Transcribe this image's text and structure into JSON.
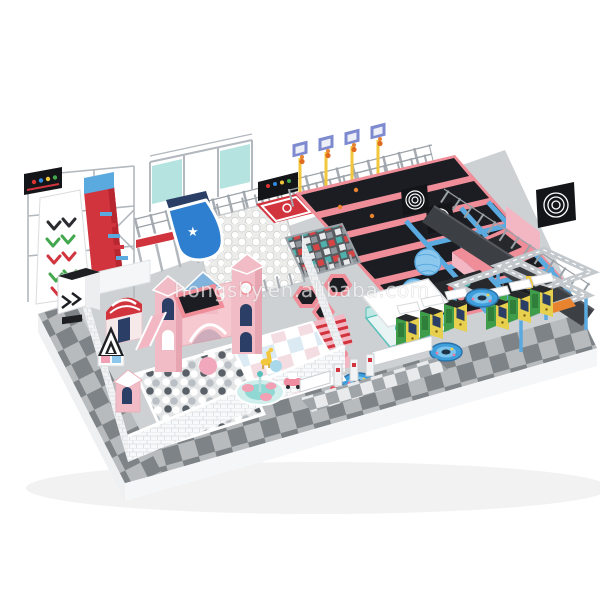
{
  "scene": {
    "type": "3d-render-indoor-playground-trampoline-park",
    "view": "isometric-product-render-on-white",
    "watermark": {
      "text": "hongshy.en.alibaba.com"
    },
    "areas": [
      {
        "name": "giant-chevron-slide",
        "color": "#f6f7f8"
      },
      {
        "name": "red-drop-slide",
        "color": "#d2343e"
      },
      {
        "name": "graffiti-signs",
        "color": "#141519"
      },
      {
        "name": "steel-mezzanine-frame",
        "color": "#b2b8be"
      },
      {
        "name": "blue-star-slide",
        "color": "#2f7fd0"
      },
      {
        "name": "white-ball-pit",
        "color": "#ececea"
      },
      {
        "name": "foam-cube-pit",
        "colors": [
          "#4fb0ac",
          "#d64545",
          "#e8eaeb"
        ]
      },
      {
        "name": "red-court-pad",
        "color": "#d2343e"
      },
      {
        "name": "dunk-basketball-hoops",
        "count": 4
      },
      {
        "name": "trampoline-grid-pink",
        "color": "#ef8e98"
      },
      {
        "name": "trampoline-grid-blue",
        "color": "#5aaae0"
      },
      {
        "name": "blue-wrecking-balls",
        "count": 2
      },
      {
        "name": "spiral-dart-targets",
        "count": 3
      },
      {
        "name": "stunt-jump-wedge",
        "color": "#ef8e98"
      },
      {
        "name": "ninja-truss-course",
        "color": "#c3c8cd"
      },
      {
        "name": "dark-walkway",
        "color": "#3c4045"
      },
      {
        "name": "claw-machines",
        "count": 6,
        "colors": [
          "#3f9c4b",
          "#e6d04e"
        ]
      },
      {
        "name": "blue-spinning-rides",
        "count": 3,
        "color": "#3f9fdc"
      },
      {
        "name": "teal-party-kiosk",
        "color": "#58c0ba"
      },
      {
        "name": "hexagon-trampolines",
        "count": 3
      },
      {
        "name": "toddler-castle-town",
        "color": "#f2bcc6"
      },
      {
        "name": "toddler-ball-pit",
        "colors": [
          "#ffffff",
          "#b9bfc4",
          "#596067"
        ]
      },
      {
        "name": "pastel-checker-floor",
        "colors": [
          "#f3dde3",
          "#dceaf4"
        ]
      },
      {
        "name": "soft-seat-carousel",
        "color": "#f2a0b4"
      },
      {
        "name": "ride-on-cars",
        "count": 2
      },
      {
        "name": "entrance-turnstiles",
        "count": 3
      },
      {
        "name": "checkerboard-apron",
        "colors": [
          "#7e8387",
          "#b7bbbe"
        ]
      }
    ]
  },
  "icons": {
    "star": "★"
  },
  "palette": {
    "white": "#ffffff",
    "floor": "#cdd1d4",
    "slabSide": "#eef0f1",
    "slabSideLight": "#f5f6f7",
    "checkerDark": "#7e8387",
    "checkerMid": "#b7bbbe",
    "gateCheckA": "#9fa4a8",
    "gateCheckB": "#e8eaeb",
    "steel": "#b2b8be",
    "steelDark": "#9aa1a7",
    "fence": "#a5abb1",
    "pink": "#ef8e98",
    "pinkLight": "#f3b7c4",
    "pinkPale": "#f6c9d1",
    "castlePink": "#f2bcc6",
    "castleSide": "#e6a5b1",
    "red": "#d2343e",
    "crimson": "#b8262f",
    "navy": "#2b3f66",
    "blue": "#5aaae0",
    "blueDeep": "#2f7fd0",
    "bluePale": "#8cc8ee",
    "tramp": "#1b1d22",
    "dark": "#26282c",
    "signBlack": "#141519",
    "teal": "#58c0ba",
    "tealPale": "#bfe8e5",
    "green": "#43a84d",
    "yellow": "#f2c73c",
    "orange": "#e8832f",
    "arcadeYellow": "#e6d04e",
    "arcadeGreen": "#3f9c4b",
    "walkway": "#3c4045",
    "ballBase": "#ececea",
    "ballShadow": "#d5d7d5",
    "ballGray": "#b9bfc4",
    "ballDark": "#596067",
    "pastelPink": "#f3dde3",
    "pastelBlue": "#dceaf4",
    "foamTeal": "#4fb0ac",
    "foamRed": "#d64545",
    "foamGray": "#8e959b",
    "boardPurple": "#7e8ad0",
    "spinBlue": "#3f9fdc",
    "spinLight": "#7cc4ec"
  }
}
